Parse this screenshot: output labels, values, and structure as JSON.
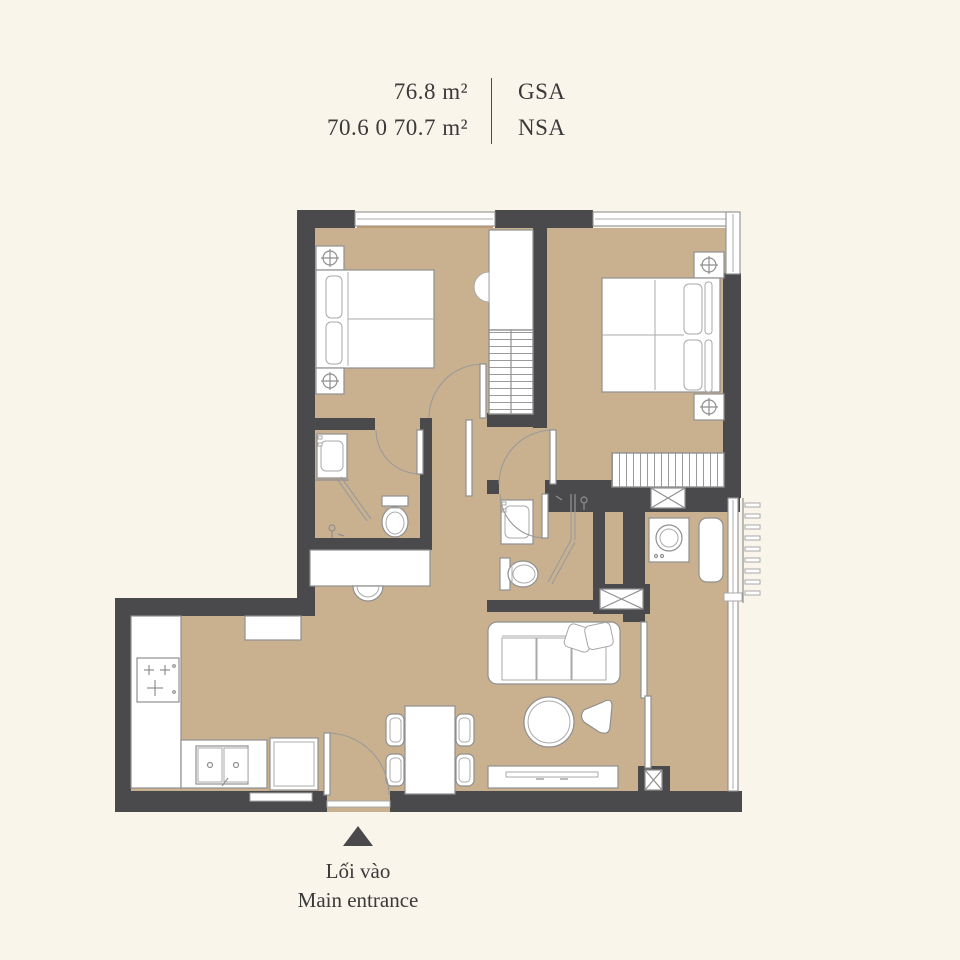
{
  "header": {
    "gsa_value": "76.8 m²",
    "gsa_label": "GSA",
    "nsa_value": "70.6 0 70.7 m²",
    "nsa_label": "NSA"
  },
  "entrance": {
    "label_vi": "Lối vào",
    "label_en": "Main entrance",
    "marker_icon": "triangle-up-icon"
  },
  "colors": {
    "background": "#FAF5EA",
    "floor": "#C9B190",
    "wall": "#4A4A4C",
    "outline": "#8F8F8F",
    "text": "#3A3A3A"
  }
}
